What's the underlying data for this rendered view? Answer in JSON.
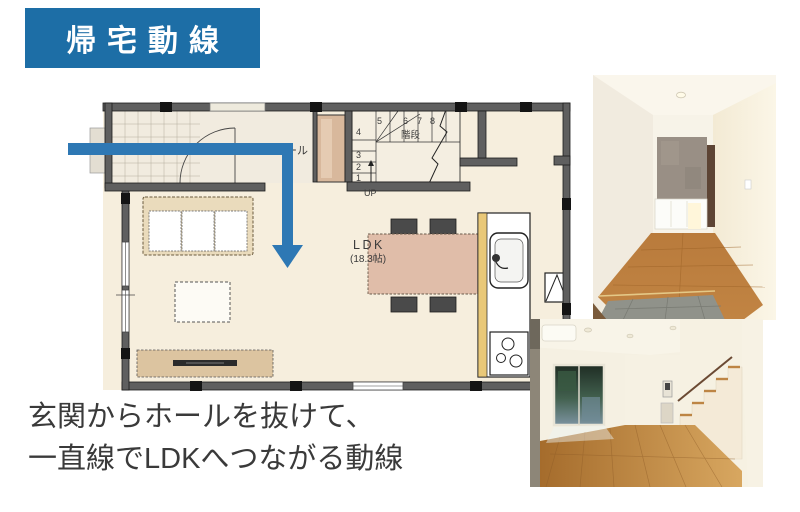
{
  "badge": {
    "label": "帰宅動線",
    "bg": "#1d6ea6",
    "text_color": "#ffffff"
  },
  "caption": {
    "line1": "玄関からホールを抜けて、",
    "line2": "一直線でLDKへつながる動線"
  },
  "floorplan": {
    "arrow_color": "#2e78b4",
    "labels": {
      "hall": "ホール",
      "ldk": "LDK",
      "ldk_area": "(18.3帖)",
      "stairs": "階段",
      "up": "UP"
    },
    "stair_numbers_top": [
      "5",
      "6",
      "7",
      "8"
    ],
    "stair_numbers_side": [
      "4",
      "3",
      "2",
      "1"
    ]
  },
  "photos": {
    "top": "entrance-hallway-photo",
    "bottom": "ldk-room-photo"
  }
}
